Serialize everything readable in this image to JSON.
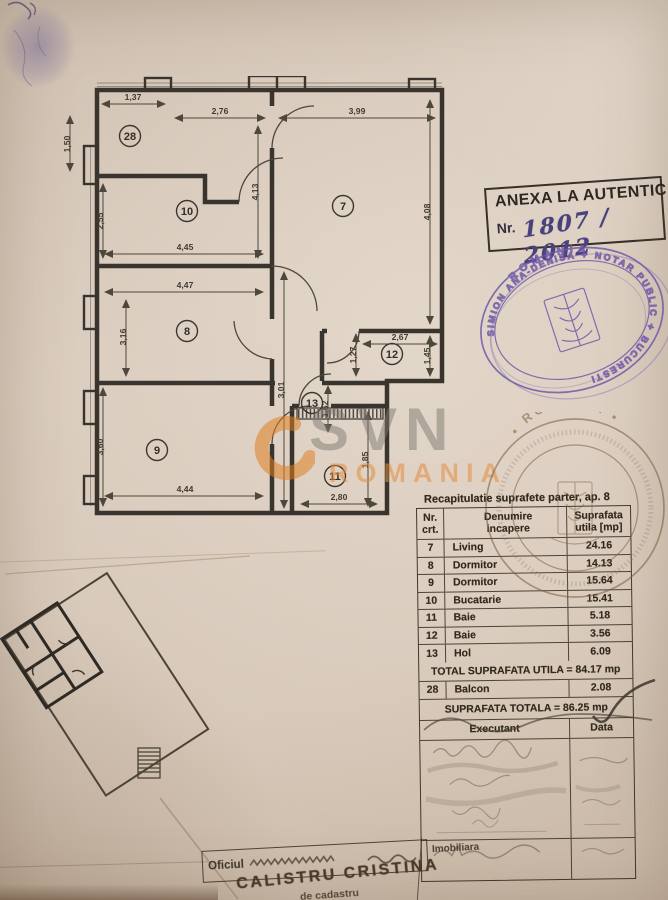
{
  "anexa": {
    "title": "ANEXA LA AUTENTIC",
    "nr_label": "Nr.",
    "nr_value": "1807 / 2012"
  },
  "notary_stamp": {
    "country": "ROMANIA",
    "ring_text": "SIMION ANA-DENISA ✦ NOTAR PUBLIC ✦ BUCURESTI"
  },
  "gov_stamp": {
    "country": "• ROMANIA •"
  },
  "watermark": {
    "brand": "SVN",
    "country": "ROMANIA"
  },
  "floor_plan": {
    "rooms": [
      {
        "n": "28",
        "x": 73,
        "y": 60
      },
      {
        "n": "10",
        "x": 130,
        "y": 135
      },
      {
        "n": "7",
        "x": 286,
        "y": 130
      },
      {
        "n": "8",
        "x": 130,
        "y": 255
      },
      {
        "n": "12",
        "x": 335,
        "y": 278
      },
      {
        "n": "13",
        "x": 255,
        "y": 327
      },
      {
        "n": "9",
        "x": 100,
        "y": 374
      },
      {
        "n": "11",
        "x": 278,
        "y": 400
      }
    ],
    "dims": [
      {
        "t": "1,37",
        "x": 76,
        "y": 24,
        "r": 0
      },
      {
        "t": "2,76",
        "x": 163,
        "y": 38,
        "r": 0
      },
      {
        "t": "3,99",
        "x": 300,
        "y": 38,
        "r": 0
      },
      {
        "t": "1,50",
        "x": 13,
        "y": 68,
        "r": -90
      },
      {
        "t": "2,55",
        "x": 46,
        "y": 145,
        "r": -90
      },
      {
        "t": "4,13",
        "x": 201,
        "y": 116,
        "r": -90
      },
      {
        "t": "4,08",
        "x": 373,
        "y": 136,
        "r": -90
      },
      {
        "t": "4,45",
        "x": 128,
        "y": 174,
        "r": 0
      },
      {
        "t": "4,47",
        "x": 128,
        "y": 212,
        "r": 0
      },
      {
        "t": "3,16",
        "x": 69,
        "y": 261,
        "r": -90
      },
      {
        "t": "2,67",
        "x": 343,
        "y": 264,
        "r": 0
      },
      {
        "t": "1,27",
        "x": 299,
        "y": 279,
        "r": -90
      },
      {
        "t": "1,45",
        "x": 373,
        "y": 280,
        "r": -90
      },
      {
        "t": "3,01",
        "x": 227,
        "y": 314,
        "r": -90
      },
      {
        "t": "1,62",
        "x": 271,
        "y": 333,
        "r": -90
      },
      {
        "t": "3,60",
        "x": 46,
        "y": 371,
        "r": -90
      },
      {
        "t": "1,85",
        "x": 311,
        "y": 384,
        "r": -90
      },
      {
        "t": "4,44",
        "x": 128,
        "y": 416,
        "r": 0
      },
      {
        "t": "2,80",
        "x": 282,
        "y": 424,
        "r": 0
      }
    ]
  },
  "table": {
    "title": "Recapitulatie suprafete parter, ap. 8",
    "col_nr_1": "Nr.",
    "col_nr_2": "crt.",
    "col_name_1": "Denumire",
    "col_name_2": "incapere",
    "col_area_1": "Suprafata",
    "col_area_2": "utila [mp]",
    "rows": [
      {
        "nr": "7",
        "name": "Living",
        "area": "24.16"
      },
      {
        "nr": "8",
        "name": "Dormitor",
        "area": "14.13"
      },
      {
        "nr": "9",
        "name": "Dormitor",
        "area": "15.64"
      },
      {
        "nr": "10",
        "name": "Bucatarie",
        "area": "15.41"
      },
      {
        "nr": "11",
        "name": "Baie",
        "area": "5.18"
      },
      {
        "nr": "12",
        "name": "Baie",
        "area": "3.56"
      },
      {
        "nr": "13",
        "name": "Hol",
        "area": "6.09"
      }
    ],
    "total_utila": "TOTAL SUPRAFATA UTILA = 84.17 mp",
    "balcon": {
      "nr": "28",
      "name": "Balcon",
      "area": "2.08"
    },
    "total": "SUPRAFATA TOTALA = 86.25 mp",
    "executant_label": "Executant",
    "data_label": "Data"
  },
  "footer": {
    "office_left": "Oficiul",
    "office_right": "Imobiliara",
    "name": "CALISTRU CRISTINA",
    "role": "de cadastru"
  }
}
